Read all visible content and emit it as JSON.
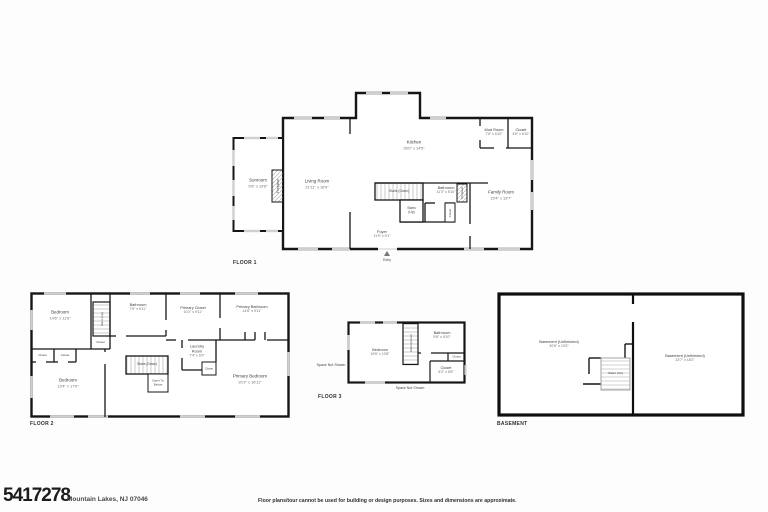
{
  "document": {
    "mls_number": "5417278",
    "address": "Mountain Lakes, NJ 07046",
    "disclaimer": "Floor plans/tour cannot be used for building or design purposes. Sizes and dimensions are approximate."
  },
  "floor1": {
    "label": "FLOOR 1",
    "rooms": {
      "sunroom": {
        "name": "Sunroom",
        "dims": "9'6\" x 19'8\""
      },
      "fireplace_left": {
        "name": "Fireplace"
      },
      "living_room": {
        "name": "Living Room",
        "dims": "21'11\" x 16'9\""
      },
      "kitchen": {
        "name": "Kitchen",
        "dims": "26'0\" x 14'5\""
      },
      "mud_room": {
        "name": "Mud Room",
        "dims": "7'6\" x 6'10\""
      },
      "closet": {
        "name": "Closet",
        "dims": "4'6\" x 6'10\""
      },
      "stairs_down": {
        "name": "Stairs (Down)"
      },
      "stairs_up": {
        "name": "Stairs (Up)"
      },
      "bathroom": {
        "name": "Bathroom",
        "dims": "11'3\" x 5'10\""
      },
      "closet2": {
        "name": "Closet"
      },
      "fireplace_right": {
        "name": "Fireplace"
      },
      "family_room": {
        "name": "Family Room",
        "dims": "15'4\" x 19'7\""
      },
      "foyer": {
        "name": "Foyer",
        "dims": "11'9\" x 9'1\""
      },
      "entry": {
        "name": "Entry"
      }
    }
  },
  "floor2": {
    "label": "FLOOR 2",
    "rooms": {
      "bedroom_tl": {
        "name": "Bedroom",
        "dims": "14'6\" x 11'6\""
      },
      "stairs_up": {
        "name": "Stairs (Up)"
      },
      "closet_a": {
        "name": "Closet"
      },
      "bathroom": {
        "name": "Bathroom",
        "dims": "7'5\" x 6'11\""
      },
      "primary_closet": {
        "name": "Primary Closet",
        "dims": "10'2\" x 9'11\""
      },
      "primary_bathroom": {
        "name": "Primary Bathroom",
        "dims": "14'6\" x 9'11\""
      },
      "closet_b": {
        "name": "Closet"
      },
      "closet_c": {
        "name": "Closet"
      },
      "bedroom_bl": {
        "name": "Bedroom",
        "dims": "13'4\" x 17'6\""
      },
      "stairs_down": {
        "name": "Stairs (Down)"
      },
      "open_below": {
        "name": "Open To Below"
      },
      "laundry": {
        "name": "Laundry Room",
        "dims": "7'4\" x 6'9\""
      },
      "closet_d": {
        "name": "Closet"
      },
      "primary_bedroom": {
        "name": "Primary Bedroom",
        "dims": "20'2\" x 16'11\""
      }
    }
  },
  "floor3": {
    "label": "FLOOR 3",
    "rooms": {
      "space_left": {
        "name": "Space Not Shown"
      },
      "bedroom": {
        "name": "Bedroom",
        "dims": "19'6\" x 13'8\""
      },
      "stairs_down": {
        "name": "Stairs (Down)"
      },
      "bathroom": {
        "name": "Bathroom",
        "dims": "9'8\" x 5'10\""
      },
      "closet_small": {
        "name": "Closet"
      },
      "closet": {
        "name": "Closet",
        "dims": "5'2\" x 5'8\""
      },
      "space_bottom": {
        "name": "Space Not Shown"
      }
    }
  },
  "basement": {
    "label": "BASEMENT",
    "rooms": {
      "left": {
        "name": "Basement (Unfinished)",
        "dims": "30'6\" x 19'3\""
      },
      "stairs_up": {
        "name": "Stairs (Up)"
      },
      "right": {
        "name": "Basement (Unfinished)",
        "dims": "23'7\" x 18'2\""
      }
    }
  }
}
